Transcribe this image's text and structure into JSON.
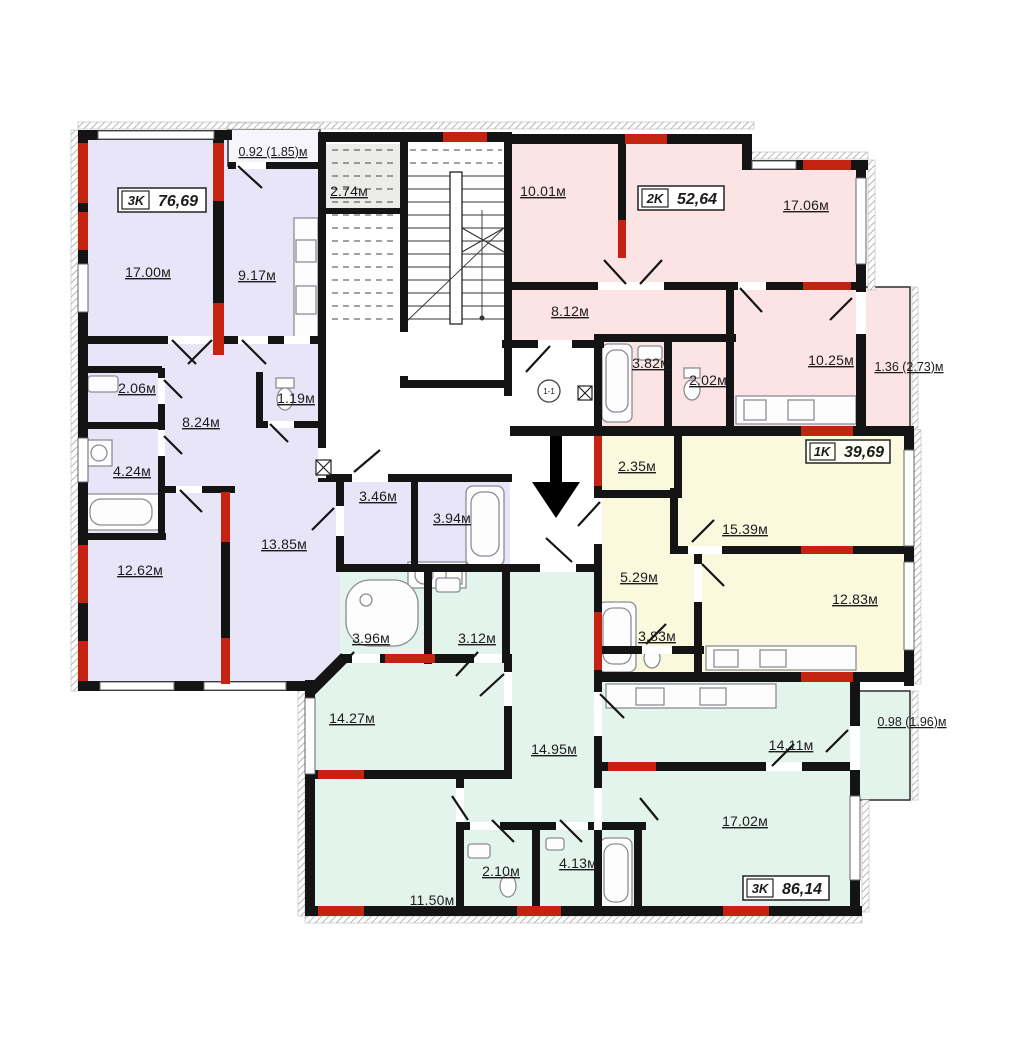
{
  "fp": {
    "apartments": [
      {
        "type": "3K",
        "area": "76,69",
        "balcony": "0.92 (1.85)м",
        "rooms": [
          "17.00м",
          "9.17м",
          "2.06м",
          "8.24м",
          "1.19м",
          "4.24м",
          "12.62м",
          "13.85м",
          "3.46м",
          "3.94м"
        ]
      },
      {
        "type": "2K",
        "area": "52,64",
        "balcony": "1.36 (2.73)м",
        "rooms": [
          "10.01м",
          "17.06м",
          "8.12м",
          "3.82м",
          "2.02м",
          "10.25м"
        ]
      },
      {
        "type": "1K",
        "area": "39,69",
        "rooms": [
          "2.35м",
          "15.39м",
          "5.29м",
          "12.83м",
          "3.83м"
        ]
      },
      {
        "type": "3K",
        "area": "86,14",
        "balcony": "0.98 (1.96)м",
        "rooms": [
          "3.96м",
          "3.12м",
          "14.27м",
          "14.95м",
          "14.11м",
          "17.02м",
          "11.50м",
          "2.10м",
          "4.13м"
        ]
      }
    ],
    "common": {
      "elevator": "2.74м",
      "door_marker": "1-1"
    },
    "colors": {
      "apt_3k_left": "#e7e5f7",
      "apt_2k": "#fbe4e3",
      "apt_1k": "#faf8dd",
      "apt_3k_bottom": "#e3f4ec",
      "elevator": "#ececea",
      "balcony_top": "#f6f5fc",
      "wall": "#141414",
      "red": "#c32310"
    }
  }
}
